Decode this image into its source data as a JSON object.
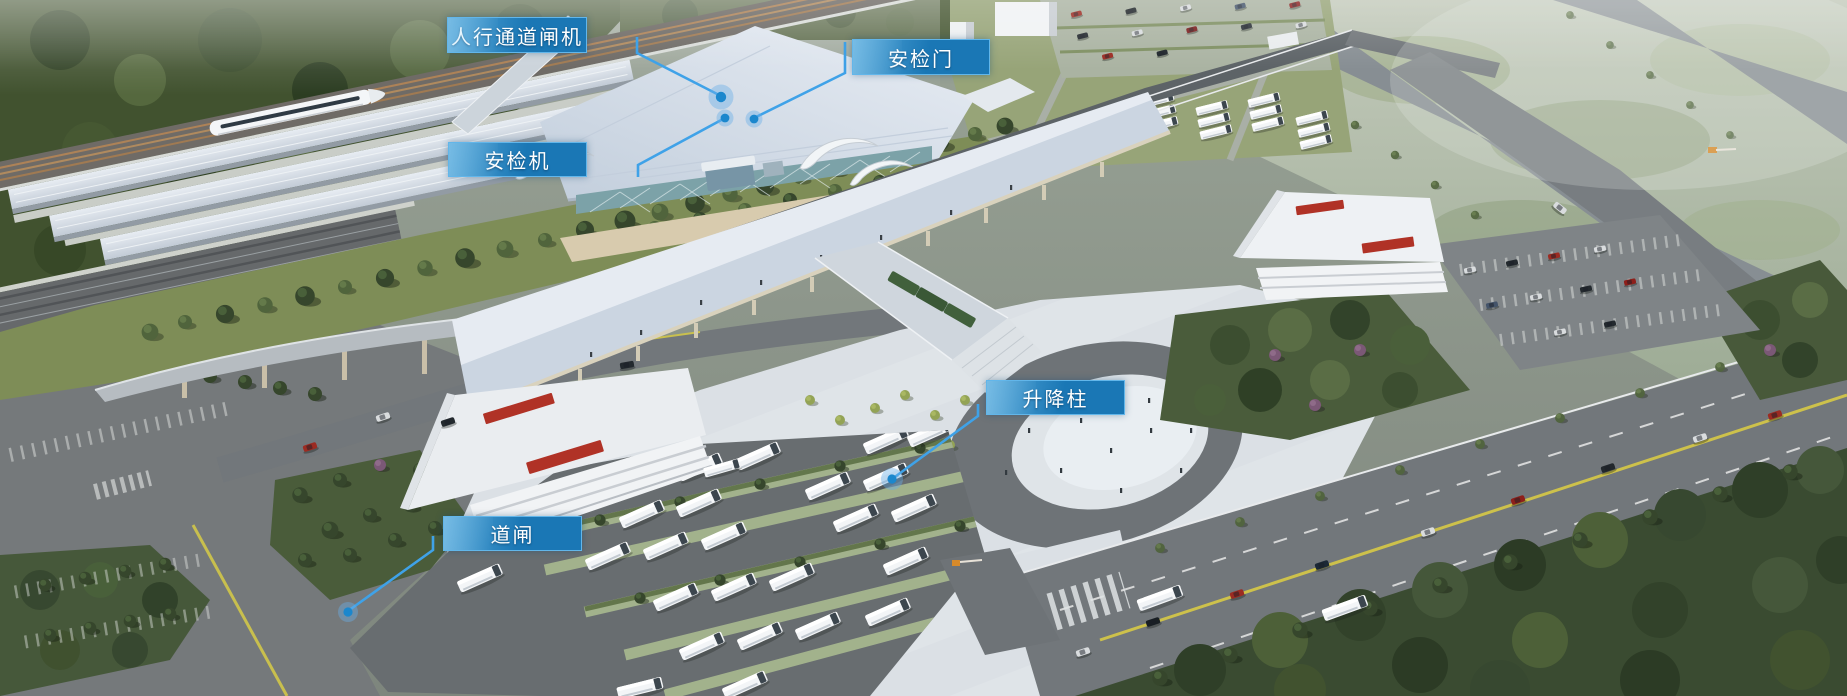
{
  "annotations": {
    "items": [
      {
        "id": "pedestrian-channel-gate",
        "label": "人行通道闸机"
      },
      {
        "id": "security-door",
        "label": "安检门"
      },
      {
        "id": "security-scanner",
        "label": "安检机"
      },
      {
        "id": "lifting-bollard",
        "label": "升降柱"
      },
      {
        "id": "road-barrier",
        "label": "道闸"
      }
    ]
  },
  "colors": {
    "label_bg": "#1a77b5",
    "label_bg_light": "#57a8d9",
    "label_border": "#62b6ea",
    "label_text": "#ffffff",
    "leader_line": "#3fa2e8",
    "marker_dot": "#1b87cd",
    "marker_halo": "rgba(105,175,230,0.42)",
    "c_road": "#5d6367",
    "c_ground_road": "#72777b",
    "c_plaza": "#dbe0e5",
    "c_canopy_a": "#cbd5e1",
    "c_canopy_b": "#e6ebf2",
    "c_roof": "#d6dfe9",
    "c_forest": "#41522f",
    "c_grass": "#7e8d57",
    "c_asphalt": "#686d70"
  }
}
